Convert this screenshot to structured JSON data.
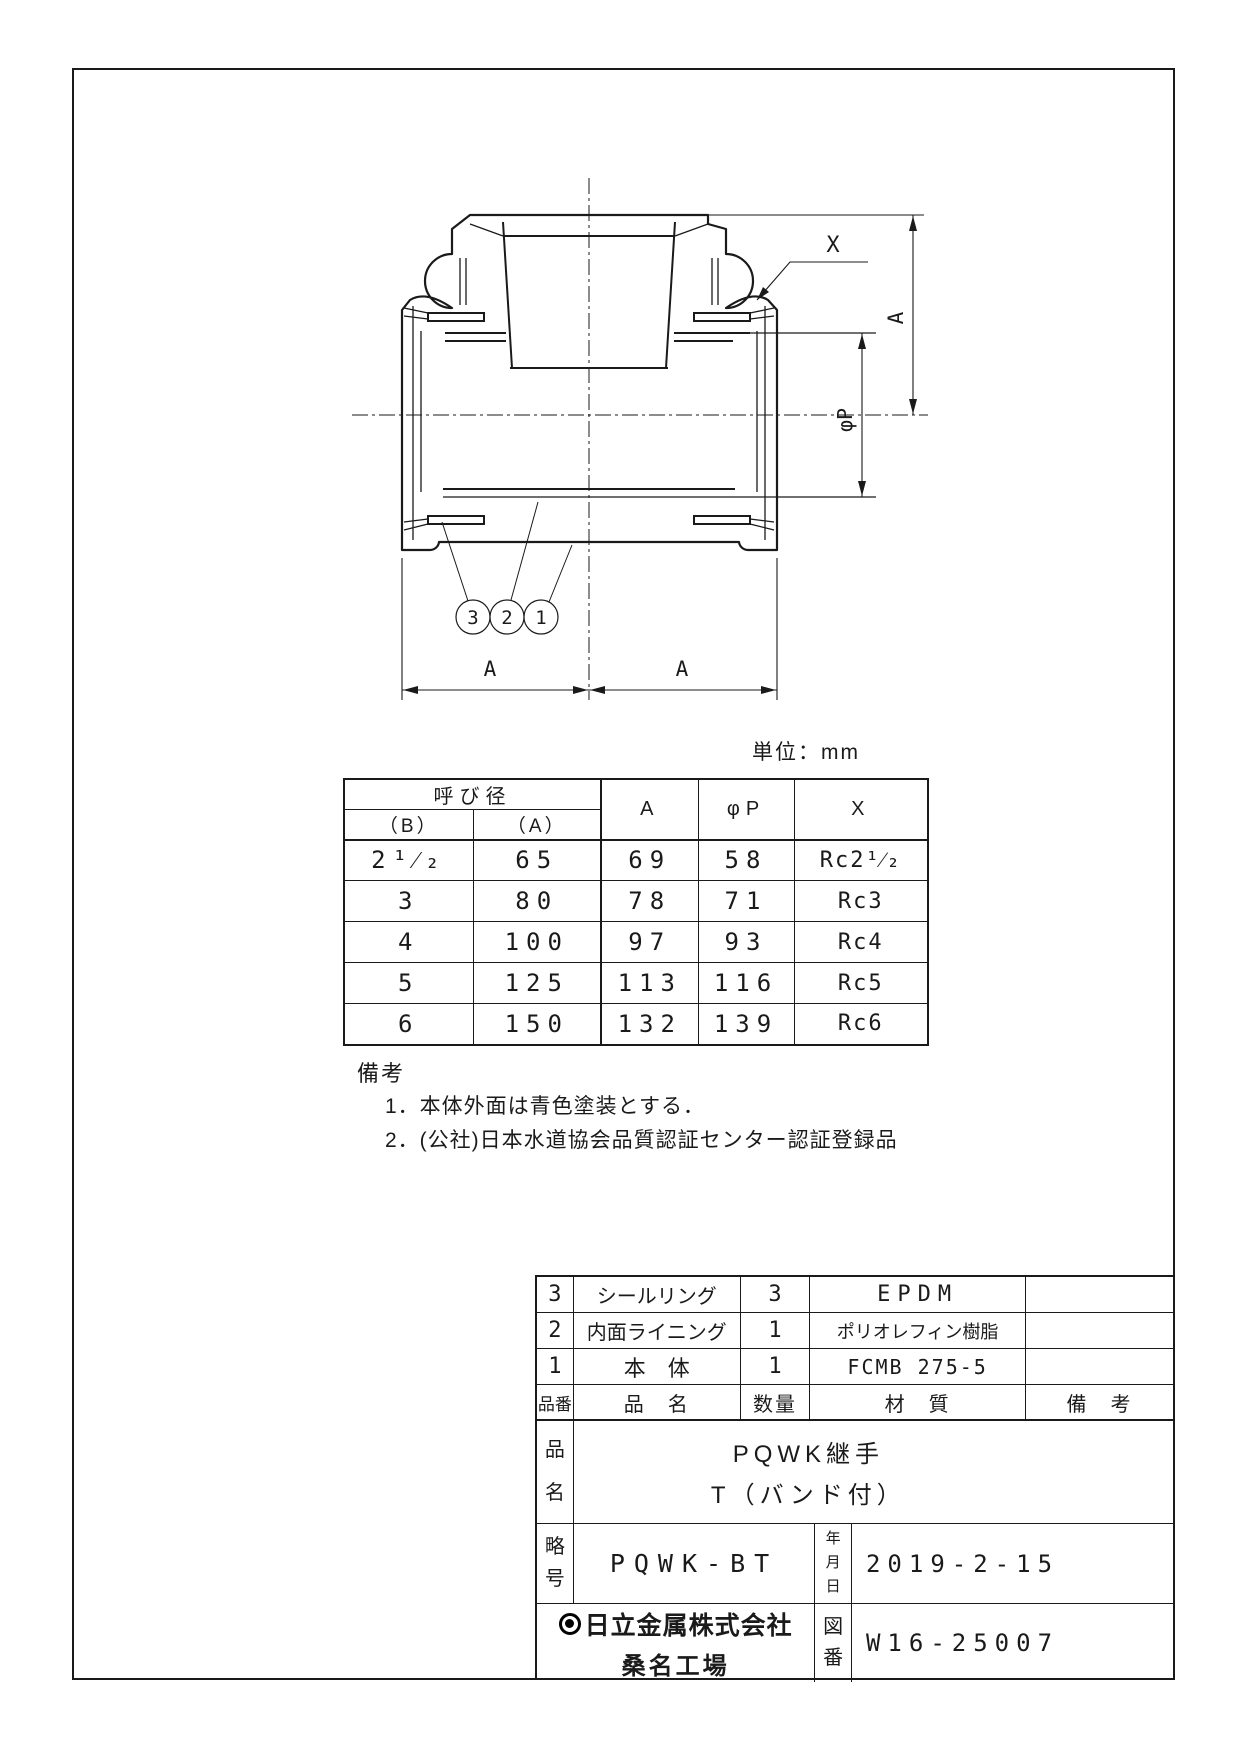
{
  "page": {
    "unit_label": "単位：mm"
  },
  "drawing": {
    "labels": {
      "x_callout": "X",
      "dim_a_vertical": "A",
      "dim_phi_p": "φP",
      "dim_a_left": "A",
      "dim_a_right": "A"
    },
    "balloons": [
      "3",
      "2",
      "1"
    ]
  },
  "spec_table": {
    "header": {
      "nominal": "呼び径",
      "b": "（B）",
      "a": "（A）",
      "col_a": "A",
      "col_phi": "φP",
      "col_x": "X"
    },
    "rows": [
      {
        "b": "2¹⁄₂",
        "a": "65",
        "dim_a": "69",
        "phi_p": "58",
        "x": "Rc2¹⁄₂"
      },
      {
        "b": "3",
        "a": "80",
        "dim_a": "78",
        "phi_p": "71",
        "x": "Rc3"
      },
      {
        "b": "4",
        "a": "100",
        "dim_a": "97",
        "phi_p": "93",
        "x": "Rc4"
      },
      {
        "b": "5",
        "a": "125",
        "dim_a": "113",
        "phi_p": "116",
        "x": "Rc5"
      },
      {
        "b": "6",
        "a": "150",
        "dim_a": "132",
        "phi_p": "139",
        "x": "Rc6"
      }
    ]
  },
  "notes": {
    "title": "備考",
    "item1": "1．本体外面は青色塗装とする．",
    "item2": "2．(公社)日本水道協会品質認証センター認証登録品"
  },
  "title_block": {
    "parts": [
      {
        "no": "3",
        "name": "シールリング",
        "qty": "3",
        "material": "EPDM"
      },
      {
        "no": "2",
        "name": "内面ライニング",
        "qty": "1",
        "material": "ポリオレフィン樹脂"
      },
      {
        "no": "1",
        "name": "本　体",
        "qty": "1",
        "material": "FCMB 275-5"
      }
    ],
    "headers": {
      "no": "品番",
      "name": "品　名",
      "qty": "数量",
      "material": "材　質",
      "remarks": "備　考"
    },
    "product": {
      "label_top": "品",
      "label_bottom": "名",
      "line1": "PQWK継手",
      "line2": "T（バンド付）"
    },
    "code": {
      "label_top": "略",
      "label_bottom": "号",
      "value": "PQWK-BT",
      "date_label_1": "年",
      "date_label_2": "月",
      "date_label_3": "日",
      "date": "2019-2-15"
    },
    "company": {
      "name": "日立金属株式会社",
      "factory": "桑名工場",
      "drawing_no_label_1": "図",
      "drawing_no_label_2": "番",
      "drawing_no": "W16-25007"
    }
  }
}
